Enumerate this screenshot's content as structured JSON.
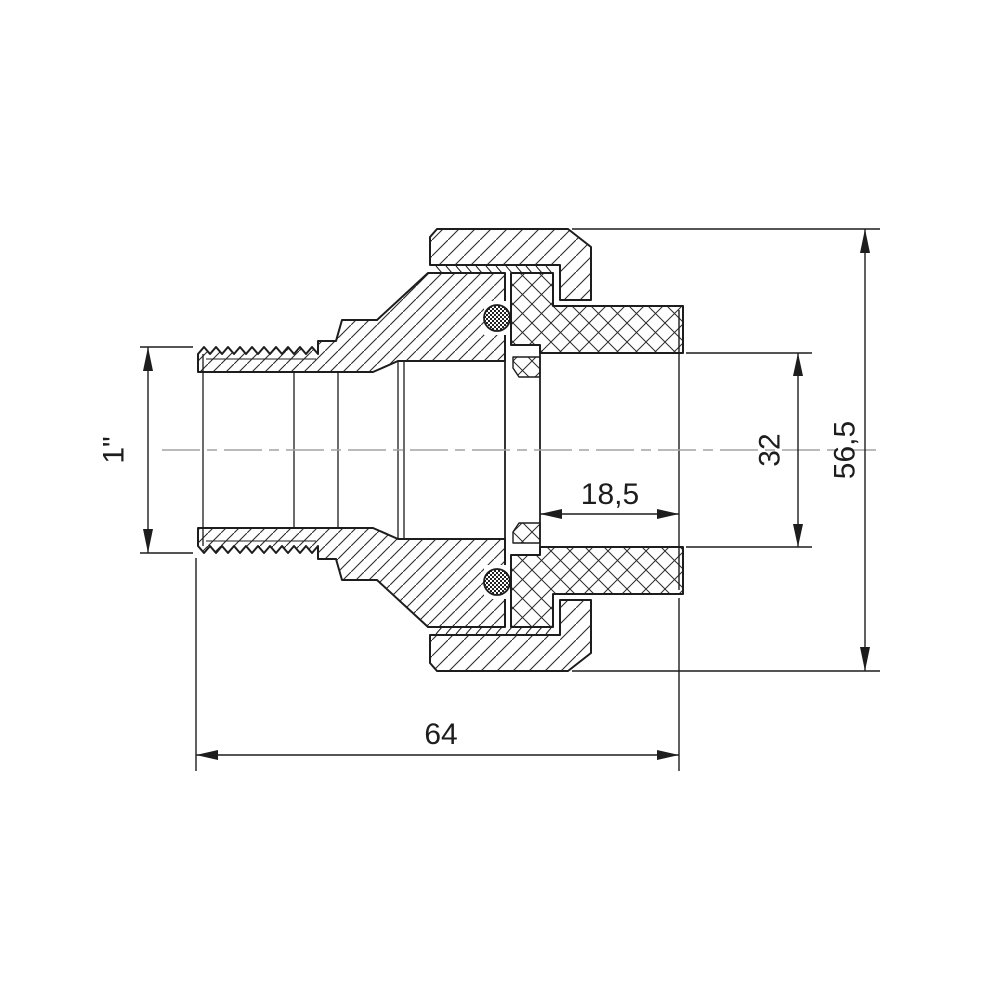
{
  "drawing": {
    "component": "union-pipe-fitting-sectional-view",
    "dimensions": {
      "thread_size": "1\"",
      "socket_depth": "18,5",
      "bore_diameter": "32",
      "body_diameter": "56,5",
      "overall_length": "64"
    },
    "colors": {
      "line": "#1d1d1d",
      "centerline": "#a3a3a3",
      "background": "#ffffff"
    }
  }
}
